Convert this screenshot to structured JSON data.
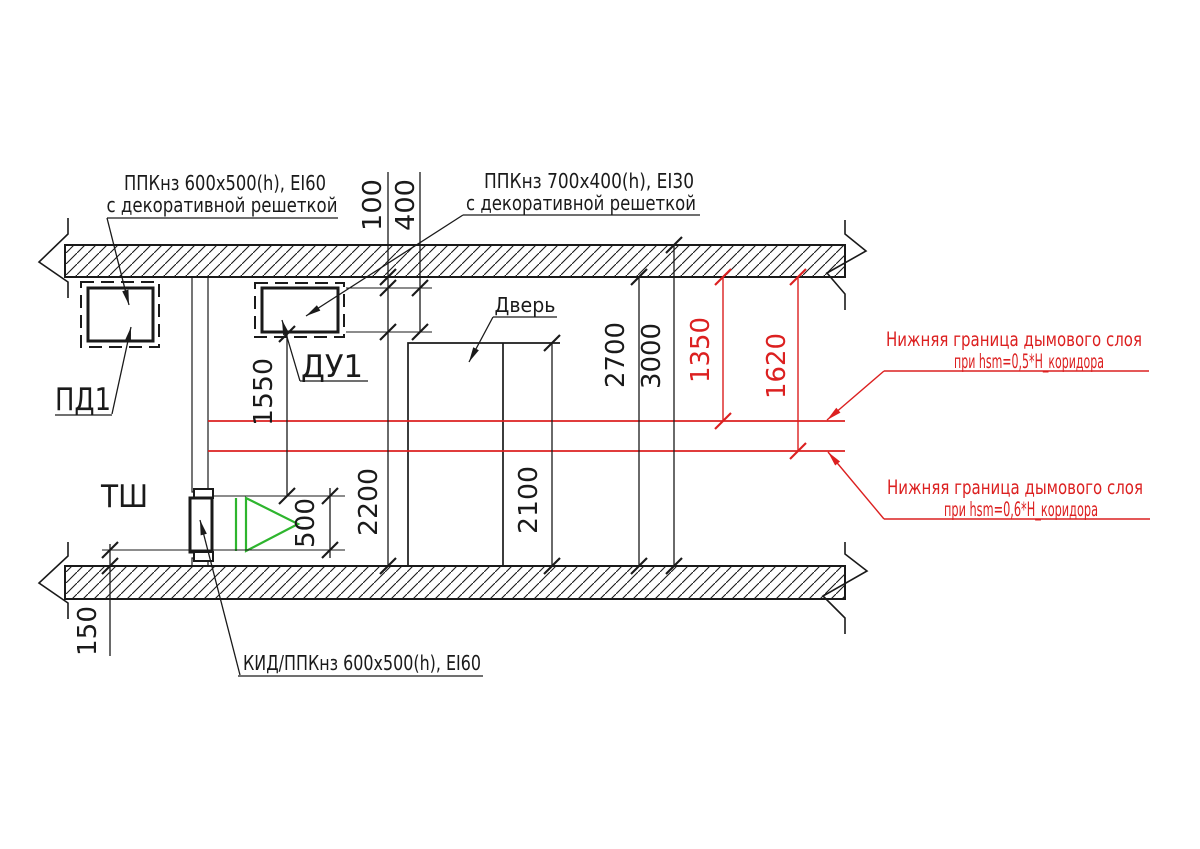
{
  "colors": {
    "line": "#1a1a1a",
    "red": "#dc2020",
    "green": "#2eb52e",
    "background": "#ffffff"
  },
  "labels": {
    "grille_left": {
      "line1": "ППКнз 600х500(h), EI60",
      "line2": "с декоративной решеткой"
    },
    "grille_right": {
      "line1": "ППКнз 700х400(h), EI30",
      "line2": "с декоративной решеткой"
    },
    "kid": "КИД/ППКнз 600х500(h), EI60",
    "pd1": "ПД1",
    "du1": "ДУ1",
    "tsh": "ТШ",
    "door": "Дверь",
    "smoke_upper": {
      "line1": "Нижняя граница дымового слоя",
      "line2": "при hsm=0,5*H_коридора"
    },
    "smoke_lower": {
      "line1": "Нижняя граница дымового слоя",
      "line2": "при hsm=0,6*H_коридора"
    }
  },
  "dimensions": {
    "d100": "100",
    "d400": "400",
    "d150": "150",
    "d500": "500",
    "d1350": "1350",
    "d1550": "1550",
    "d1620": "1620",
    "d2100": "2100",
    "d2200": "2200",
    "d2700": "2700",
    "d3000": "3000"
  }
}
